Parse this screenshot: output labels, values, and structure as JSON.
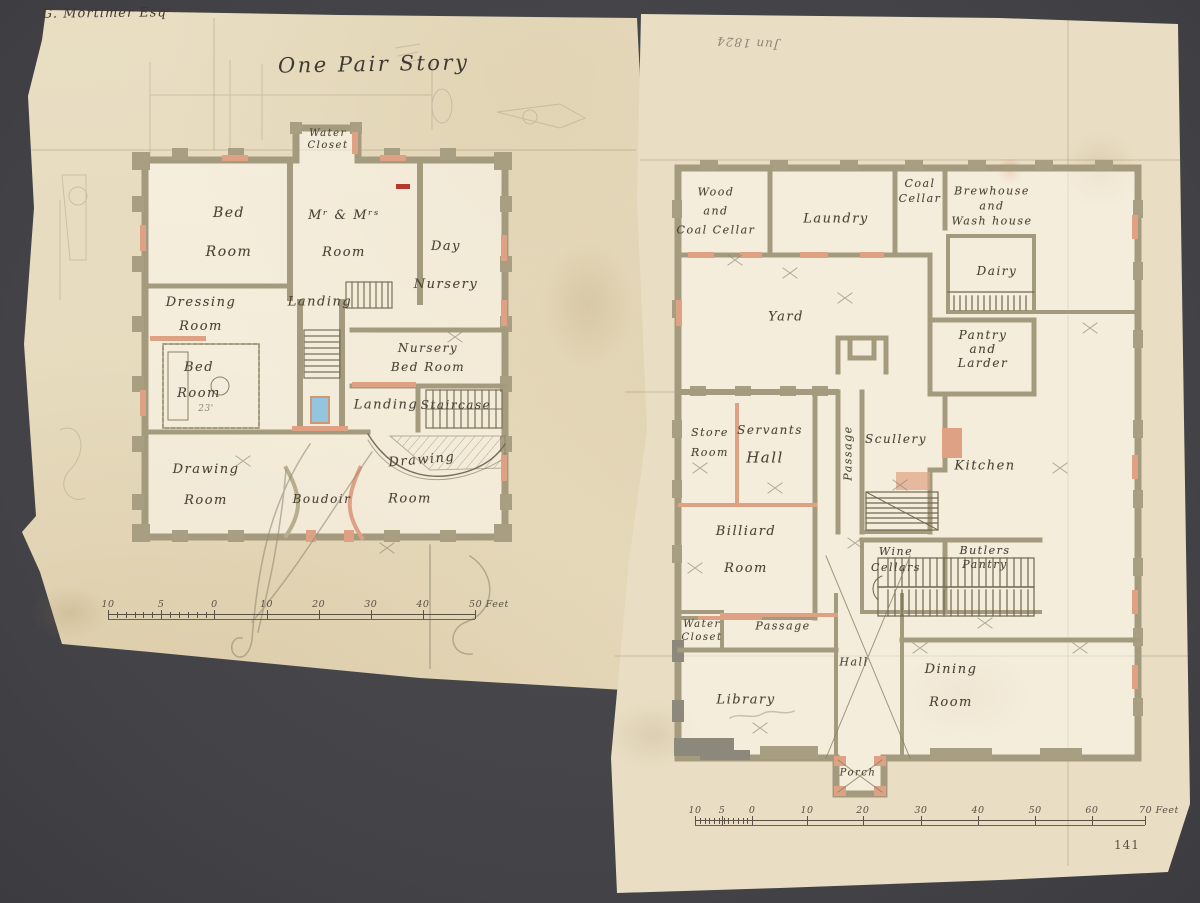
{
  "colors": {
    "background": "#46464a",
    "paper_left": "#e6dabc",
    "paper_right": "#e9dec4",
    "wall_olive": "#a49b7e",
    "wall_gray": "#8d887c",
    "accent_salmon": "#dfa183",
    "skylight_blue": "#92c6de",
    "ink": "#4a4338",
    "pencil": "#8f8674"
  },
  "sheets": {
    "left": {
      "inscription": "G. Mortimer Esqʳ",
      "title": "One Pair Story",
      "labels": [
        {
          "lines": [
            "Water",
            "Closet"
          ],
          "x": 328,
          "y": 140,
          "fs": 10,
          "lh": 12
        },
        {
          "lines": [
            "Bed",
            "Room"
          ],
          "x": 229,
          "y": 233,
          "fs": 14,
          "lh": 39
        },
        {
          "lines": [
            "Mʳ & Mʳˢ",
            "Room"
          ],
          "x": 344,
          "y": 234,
          "fs": 13,
          "lh": 37
        },
        {
          "lines": [
            "Day",
            "Nursery"
          ],
          "x": 446,
          "y": 266,
          "fs": 13,
          "lh": 38
        },
        {
          "lines": [
            "Dressing",
            "Room"
          ],
          "x": 201,
          "y": 315,
          "fs": 13,
          "lh": 24
        },
        {
          "lines": [
            "Landing"
          ],
          "x": 320,
          "y": 303,
          "fs": 13
        },
        {
          "lines": [
            "Bed",
            "Room"
          ],
          "x": 199,
          "y": 381,
          "fs": 13,
          "lh": 26
        },
        {
          "lines": [
            "23'"
          ],
          "x": 206,
          "y": 409,
          "fs": 9,
          "pencil": true
        },
        {
          "lines": [
            "Nursery",
            "Bed Room"
          ],
          "x": 428,
          "y": 358,
          "fs": 12,
          "lh": 19
        },
        {
          "lines": [
            "Landing"
          ],
          "x": 386,
          "y": 406,
          "fs": 13
        },
        {
          "lines": [
            "Staircase"
          ],
          "x": 456,
          "y": 406,
          "fs": 12
        },
        {
          "lines": [
            "Drawing",
            "Room"
          ],
          "x": 206,
          "y": 485,
          "fs": 13,
          "lh": 31
        },
        {
          "lines": [
            "Boudoir"
          ],
          "x": 322,
          "y": 500,
          "fs": 12
        },
        {
          "lines": [
            "Drawing"
          ],
          "x": 422,
          "y": 461,
          "fs": 13,
          "rot": -5
        },
        {
          "lines": [
            "Room"
          ],
          "x": 410,
          "y": 500,
          "fs": 13
        }
      ],
      "scale": {
        "x": 108,
        "y": 614,
        "length": 367,
        "sub_end": 0.29,
        "ticks": [
          {
            "f": 0,
            "label": "10"
          },
          {
            "f": 0.145,
            "label": "5"
          },
          {
            "f": 0.29,
            "label": "0"
          },
          {
            "f": 0.432,
            "label": "10"
          },
          {
            "f": 0.574,
            "label": "20"
          },
          {
            "f": 0.716,
            "label": "30"
          },
          {
            "f": 0.858,
            "label": "40"
          },
          {
            "f": 1,
            "label": "50 Feet",
            "end": true
          }
        ]
      }
    },
    "right": {
      "pencil_note": "Jun 1824",
      "archival_mark": "141",
      "labels": [
        {
          "lines": [
            "Wood",
            "and",
            "Coal Cellar"
          ],
          "x": 716,
          "y": 211,
          "fs": 11,
          "lh": 19
        },
        {
          "lines": [
            "Laundry"
          ],
          "x": 836,
          "y": 220,
          "fs": 13
        },
        {
          "lines": [
            "Coal",
            "Cellar"
          ],
          "x": 920,
          "y": 191,
          "fs": 11,
          "lh": 15
        },
        {
          "lines": [
            "Brewhouse",
            "and",
            "Wash house"
          ],
          "x": 992,
          "y": 206,
          "fs": 11,
          "lh": 15
        },
        {
          "lines": [
            "Dairy"
          ],
          "x": 997,
          "y": 272,
          "fs": 12
        },
        {
          "lines": [
            "Yard"
          ],
          "x": 786,
          "y": 318,
          "fs": 13
        },
        {
          "lines": [
            "Pantry",
            "and",
            "Larder"
          ],
          "x": 983,
          "y": 349,
          "fs": 12,
          "lh": 14
        },
        {
          "lines": [
            "Store",
            "Room"
          ],
          "x": 710,
          "y": 443,
          "fs": 11,
          "lh": 20
        },
        {
          "lines": [
            "Servants"
          ],
          "x": 770,
          "y": 431,
          "fs": 12
        },
        {
          "lines": [
            "Hall"
          ],
          "x": 765,
          "y": 458,
          "fs": 15
        },
        {
          "lines": [
            "Passage"
          ],
          "x": 849,
          "y": 453,
          "fs": 11,
          "rot": -90
        },
        {
          "lines": [
            "Scullery"
          ],
          "x": 896,
          "y": 440,
          "fs": 12
        },
        {
          "lines": [
            "Kitchen"
          ],
          "x": 985,
          "y": 467,
          "fs": 13
        },
        {
          "lines": [
            "Billiard",
            "Room"
          ],
          "x": 746,
          "y": 550,
          "fs": 13,
          "lh": 37
        },
        {
          "lines": [
            "Wine",
            "Cellars"
          ],
          "x": 896,
          "y": 560,
          "fs": 11,
          "lh": 16
        },
        {
          "lines": [
            "Butlers",
            "Pantry"
          ],
          "x": 985,
          "y": 558,
          "fs": 11,
          "lh": 14
        },
        {
          "lines": [
            "Water",
            "Closet"
          ],
          "x": 702,
          "y": 631,
          "fs": 10,
          "lh": 13
        },
        {
          "lines": [
            "Passage"
          ],
          "x": 783,
          "y": 627,
          "fs": 11
        },
        {
          "lines": [
            "Hall"
          ],
          "x": 854,
          "y": 663,
          "fs": 11
        },
        {
          "lines": [
            "Library"
          ],
          "x": 746,
          "y": 701,
          "fs": 13
        },
        {
          "lines": [
            "Dining",
            "Room"
          ],
          "x": 951,
          "y": 686,
          "fs": 13,
          "lh": 33
        },
        {
          "lines": [
            "Porch"
          ],
          "x": 858,
          "y": 773,
          "fs": 10
        }
      ],
      "scale": {
        "x": 695,
        "y": 820,
        "length": 450,
        "sub_end": 0.127,
        "ticks": [
          {
            "f": 0,
            "label": "10"
          },
          {
            "f": 0.06,
            "label": "5"
          },
          {
            "f": 0.127,
            "label": "0"
          },
          {
            "f": 0.249,
            "label": "10"
          },
          {
            "f": 0.373,
            "label": "20"
          },
          {
            "f": 0.502,
            "label": "30"
          },
          {
            "f": 0.629,
            "label": "40"
          },
          {
            "f": 0.756,
            "label": "50"
          },
          {
            "f": 0.882,
            "label": "60"
          },
          {
            "f": 1,
            "label": "70 Feet",
            "end": true
          }
        ]
      }
    }
  }
}
